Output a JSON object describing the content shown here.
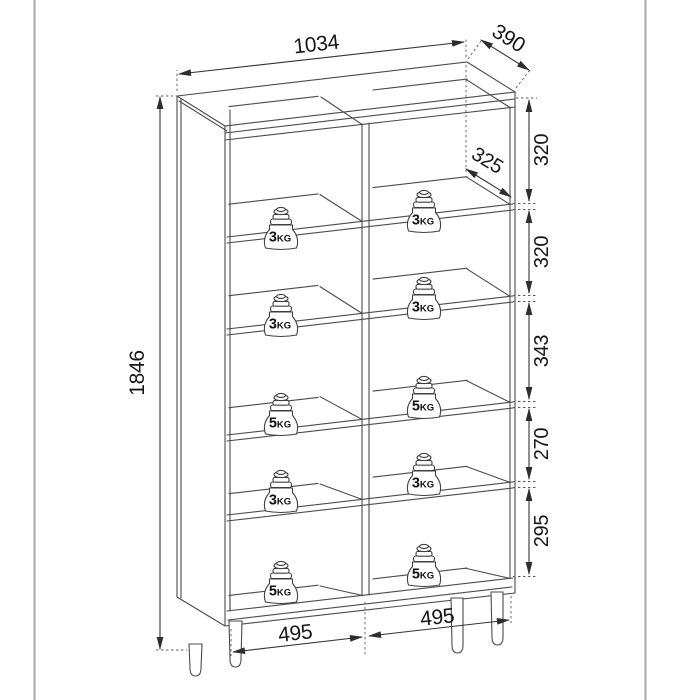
{
  "page": {
    "background": "#ffffff",
    "border_color": "#a6a6a6"
  },
  "drawing": {
    "type": "furniture-dimension-diagram",
    "dimensions": {
      "width": "1034",
      "depth": "390",
      "height": "1846",
      "shelf_depth": "325",
      "compartment_heights": [
        "320",
        "320",
        "343",
        "270",
        "295"
      ],
      "bottom_widths": [
        "495",
        "495"
      ]
    },
    "shelf_loads": {
      "left": [
        "3KG",
        "3KG",
        "5KG",
        "3KG",
        "5KG"
      ],
      "right": [
        "3KG",
        "3KG",
        "5KG",
        "3KG",
        "5KG"
      ]
    },
    "colors": {
      "line": "#4a4a4a",
      "dimension": "#2e2e2e",
      "text": "#1c1c1c"
    }
  }
}
